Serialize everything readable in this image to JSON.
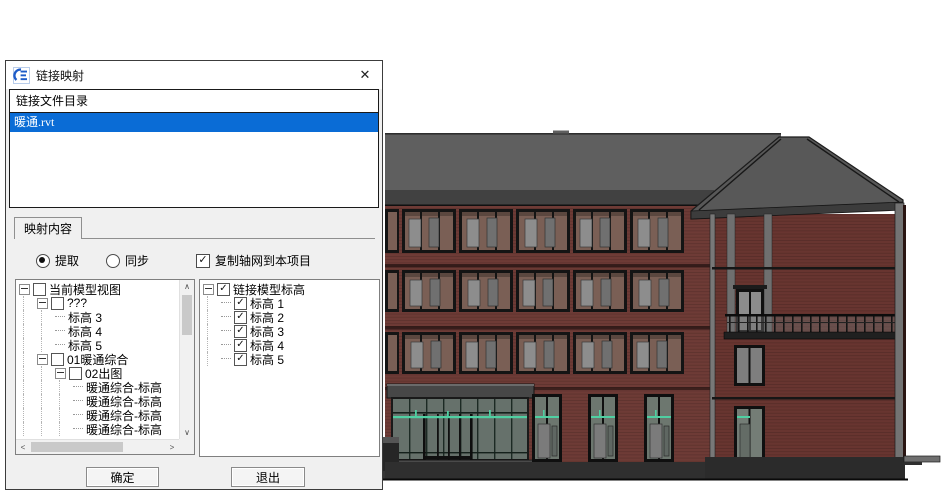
{
  "dialog": {
    "title": "链接映射",
    "close_glyph": "✕",
    "file_list": {
      "header": "链接文件目录",
      "items": [
        {
          "name": "暖通.rvt",
          "selected": true
        }
      ]
    },
    "tab": {
      "label": "映射内容"
    },
    "options": {
      "radio_extract": "提取",
      "radio_sync": "同步",
      "checkbox_copy_grid": "复制轴网到本项目",
      "extract_selected": true,
      "sync_selected": false,
      "copy_grid_checked": true,
      "check_glyph": "✓"
    },
    "left_tree": {
      "rows": [
        {
          "depth": 0,
          "expand": true,
          "checkbox": "unchecked",
          "label": "当前模型视图"
        },
        {
          "depth": 1,
          "expand": true,
          "checkbox": "unchecked",
          "label": "???"
        },
        {
          "depth": 2,
          "label": "标高 3"
        },
        {
          "depth": 2,
          "label": "标高 4"
        },
        {
          "depth": 2,
          "label": "标高 5"
        },
        {
          "depth": 1,
          "expand": true,
          "checkbox": "unchecked",
          "label": "01暖通综合"
        },
        {
          "depth": 2,
          "expand": true,
          "checkbox": "unchecked",
          "label": "02出图"
        },
        {
          "depth": 3,
          "label": "暖通综合-标高"
        },
        {
          "depth": 3,
          "label": "暖通综合-标高"
        },
        {
          "depth": 3,
          "label": "暖通综合-标高"
        },
        {
          "depth": 3,
          "label": "暖通综合-标高"
        }
      ]
    },
    "right_tree": {
      "rows": [
        {
          "depth": 0,
          "expand": true,
          "checkbox": "checked",
          "label": "链接模型标高"
        },
        {
          "depth": 1,
          "checkbox": "checked",
          "label": "标高 1"
        },
        {
          "depth": 1,
          "checkbox": "checked",
          "label": "标高 2"
        },
        {
          "depth": 1,
          "checkbox": "checked",
          "label": "标高 3"
        },
        {
          "depth": 1,
          "checkbox": "checked",
          "label": "标高 4"
        },
        {
          "depth": 1,
          "checkbox": "checked",
          "label": "标高 5"
        }
      ]
    },
    "buttons": {
      "ok": "确定",
      "exit": "退出"
    },
    "scrollbar_glyphs": {
      "up": "∧",
      "down": "∨",
      "left": "<",
      "right": ">"
    }
  },
  "viewport": {
    "description": "Revit 3D shaded view: red brick building, dark gray hip roof, three upper window rows, glazed entrance with teal duct lines, gabled end wing with balcony"
  },
  "colors": {
    "selection_blue": "#0a6cd6",
    "duct_teal": "#4fd0a2",
    "brick_wall": "#6e3b36",
    "roof_gray": "#5f5f5f",
    "dialog_bg": "#f0f0f0"
  }
}
